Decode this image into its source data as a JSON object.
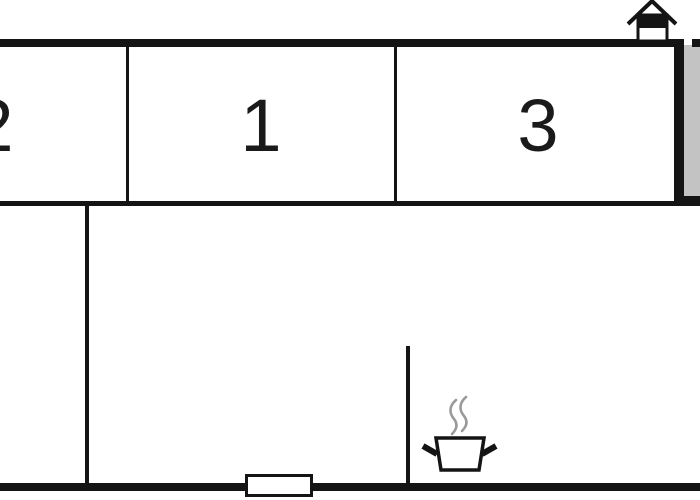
{
  "title": "Floor plan",
  "rooms": [
    {
      "id": "room-2",
      "label": "2"
    },
    {
      "id": "room-1",
      "label": "1"
    },
    {
      "id": "room-3",
      "label": "3"
    }
  ],
  "icons": {
    "entrance": "house-entrance-icon",
    "stove": "cooking-pot-with-steam-icon",
    "window": "window-symbol"
  },
  "colors": {
    "wall": "#141414",
    "terrace": "#c3c3c3",
    "steam": "#9a9a9a",
    "background": "#ffffff",
    "label": "#1a1a1a",
    "icon_fill": "#ffffff"
  }
}
